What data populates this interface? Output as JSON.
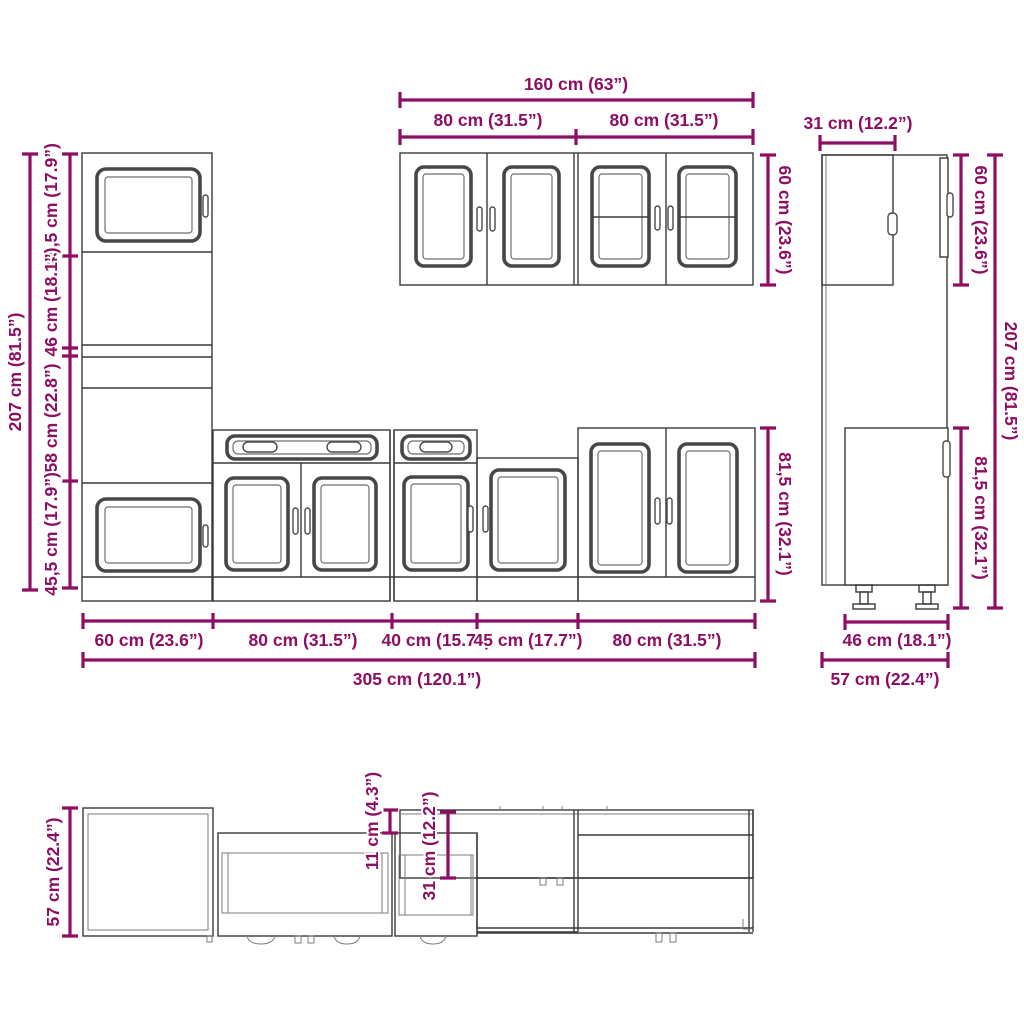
{
  "diagram": {
    "type": "kitchen-cabinet-set-dimension-diagram",
    "accent_color": "#8d0e63",
    "line_color": "#3a3a3a",
    "front_view": {
      "wall_cabinets": {
        "total_width": "160 cm (63”)",
        "left_width": "80 cm (31.5”)",
        "right_width": "80 cm (31.5”)",
        "height": "60 cm (23.6”)"
      },
      "tall_cabinet": {
        "total_height": "207 cm (81.5”)",
        "segments": [
          "45,5 cm (17.9”)",
          "46 cm (18.1”)",
          "58 cm (22.8”)",
          "45,5 cm (17.9”)"
        ]
      },
      "base_run": {
        "height": "81,5 cm (32.1”)",
        "widths": [
          "60 cm (23.6”)",
          "80 cm (31.5”)",
          "40 cm (15.7”)",
          "45 cm (17.7”)",
          "80 cm (31.5”)"
        ],
        "total_width": "305 cm (120.1”)"
      }
    },
    "side_view": {
      "top_depth": "31 cm (12.2”)",
      "upper_height": "60 cm (23.6”)",
      "total_height": "207 cm (81.5”)",
      "base_height": "81,5 cm (32.1”)",
      "base_depth": "46 cm (18.1”)",
      "total_depth": "57 cm (22.4”)"
    },
    "top_view": {
      "depth": "57 cm (22.4”)",
      "front_offset": "11 cm (4.3”)",
      "wall_depth": "31 cm (12.2”)"
    }
  }
}
